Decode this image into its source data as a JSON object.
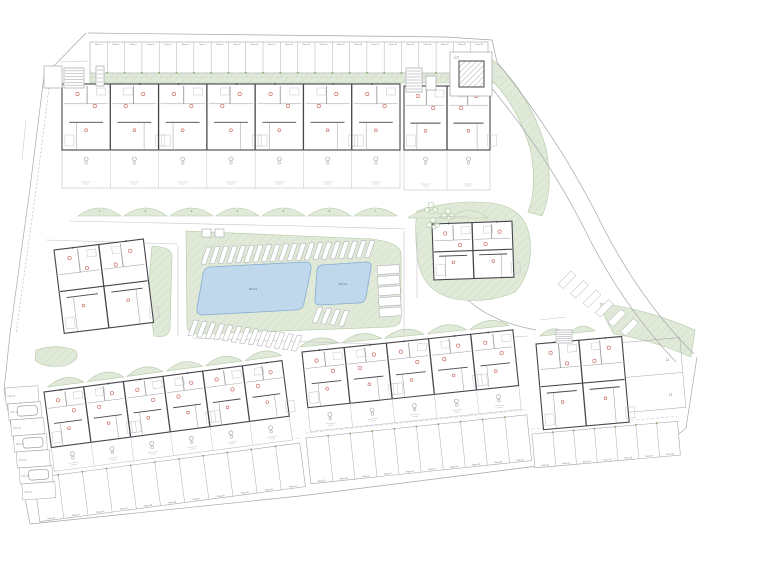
{
  "palette": {
    "green": "#e1ead9",
    "green_line": "#b3c8a6",
    "pool": "#bfd8ec",
    "pool_line": "#85aed2",
    "pool_text": "#55718f",
    "wall": "#45454c",
    "wall_light": "#9b9ba3",
    "faint": "#c3c3ca",
    "line": "#a6a6ae",
    "red": "#c65f57",
    "text": "#70707a",
    "tick_green": "#7fae6f"
  },
  "labels": {
    "ct": "CT",
    "pool_large": "Piscina",
    "pool_small": "Piscina",
    "stall_prefix": "Plaza",
    "unit_numbers_top": [
      "1",
      "2",
      "3",
      "4",
      "5",
      "6",
      "7"
    ],
    "plot_numbers": [
      "11",
      "12"
    ]
  },
  "site": {
    "boundary": [
      {
        "pts": "86,33 44,76 30,188 10,334 4,390 30,524"
      },
      {
        "pts": "88,33 446,37"
      },
      {
        "pts": "446,37 492,40 497,62"
      },
      {
        "pts": "30,524 300,496 522,468 660,450 686,428 697,357"
      },
      {
        "pts": "50,80 36,190 16,334",
        "dash": "2,2",
        "w": 0.5
      }
    ],
    "roads": [
      {
        "pts": "70,221 300,226 405,229"
      },
      {
        "pts": "46,240 178,244"
      },
      {
        "pts": "404,231 404,333"
      },
      {
        "pts": "417,232 417,298"
      },
      {
        "pts": "192,338 405,345"
      },
      {
        "pts": "405,345 528,336"
      },
      {
        "pts": "178,246 178,336"
      }
    ],
    "road_curves": [
      "M497,62 Q560,140 602,225 Q640,300 694,354",
      "M480,74 Q545,150 586,232 Q622,305 676,362",
      "M468,300 Q492,322 536,330"
    ],
    "greens": [
      {
        "name": "green-top-strip",
        "d": "M90,71 L505,71 L505,83 L90,83 Z"
      },
      {
        "name": "green-right-band",
        "d": "M489,57 Q528,88 546,148 Q554,190 542,216 L528,212 Q538,186 530,148 Q514,96 480,70 Z"
      },
      {
        "name": "green-central-island",
        "d": "M186,231 L372,239 Q400,243 401,253 L401,318 Q401,326 390,327 L198,334 Q187,334 187,325 Z"
      },
      {
        "name": "green-community",
        "d": "M417,211 Q452,199 492,203 Q527,208 530,240 Q533,272 515,292 Q488,304 455,299 Q423,292 418,261 Q414,232 417,211 Z"
      },
      {
        "name": "green-band-left",
        "d": "M152,246 Q173,247 172,257 L170,328 Q169,339 154,336 Q148,295 150,268 Z"
      },
      {
        "name": "green-blob-left",
        "d": "M36,350 Q58,343 76,351 Q81,361 64,366 Q43,368 35,360 Z"
      },
      {
        "name": "green-right-wedge",
        "d": "M600,303 Q650,310 695,330 L691,357 Q655,341 614,334 Q604,318 600,303 Z"
      }
    ],
    "mound_rows": [
      {
        "name": "gardens-top",
        "x": 78,
        "y": 216,
        "n": 7,
        "w": 43,
        "gap": 3,
        "rise": 16,
        "dy": 0
      },
      {
        "name": "gardens-top-b",
        "x": 408,
        "y": 218,
        "n": 2,
        "w": 38,
        "gap": 4,
        "rise": 15,
        "dy": 0
      },
      {
        "name": "gardens-bottom-left",
        "x": 48,
        "y": 387,
        "n": 6,
        "w": 36,
        "gap": 3.5,
        "rise": 14,
        "dy": -0.134
      },
      {
        "name": "gardens-bottom-mid",
        "x": 300,
        "y": 347,
        "n": 5,
        "w": 39,
        "gap": 3.5,
        "rise": 14,
        "dy": -0.103
      },
      {
        "name": "gardens-bottom-right",
        "x": 540,
        "y": 336,
        "n": 2,
        "w": 26,
        "gap": 3,
        "rise": 12,
        "dy": -0.09
      }
    ],
    "pools": [
      {
        "name": "pool-large",
        "label": "pool_large",
        "lx": 253,
        "ly": 290,
        "d": "M210,267 L305,262 Q312,262 311,269 L304,303 Q303,310 295,310 L203,315 Q196,315 197,308 L203,274 Q204,268 210,267 Z"
      },
      {
        "name": "pool-small",
        "label": "pool_small",
        "lx": 343,
        "ly": 285,
        "d": "M322,265 L366,262 Q372,262 371,268 L366,297 Q365,303 358,303 L320,305 Q314,305 315,299 L317,271 Q317,266 322,265 Z"
      }
    ],
    "parking_rows": [
      {
        "name": "parking-row-top",
        "x": 90,
        "y": 42,
        "w": 398,
        "h": 31,
        "n": 23,
        "rot": 0,
        "start": 1,
        "labelPos": "top",
        "ticks": true,
        "tickPos": "bottom",
        "dashDy": 35,
        "dashExt": 17
      },
      {
        "name": "parking-band-bottom-left",
        "x": 34,
        "y": 478,
        "w": 268,
        "h": 44,
        "n": 11,
        "rot": -7.5,
        "start": 31,
        "labelPos": "bottom",
        "ticks": true,
        "tickPos": "top",
        "dashDy": -5
      },
      {
        "name": "parking-band-bottom-mid",
        "x": 306,
        "y": 438,
        "w": 222,
        "h": 46,
        "n": 10,
        "rot": -6,
        "start": 42,
        "labelPos": "bottom",
        "ticks": true,
        "tickPos": "top",
        "dashDy": -5
      },
      {
        "name": "parking-band-bottom-right",
        "x": 532,
        "y": 434,
        "w": 146,
        "h": 34,
        "n": 7,
        "rot": -5,
        "start": 52,
        "labelPos": "bottom",
        "ticks": true,
        "tickPos": "top",
        "dashDy": -5
      }
    ],
    "stall_column": {
      "name": "parking-column-left",
      "x": 5,
      "y": 388,
      "w": 33,
      "h": 16,
      "n": 7,
      "shift": 2.8,
      "rot": -4,
      "start": 24,
      "cars": [
        1,
        3,
        5
      ]
    },
    "angled_rows": [
      {
        "name": "stalls-island-top",
        "x": 201,
        "y": 264,
        "n": 20,
        "dx": 8.6,
        "dy": -0.35,
        "a": [
          4.8,
          0.2
        ],
        "b": [
          5.7,
          -17
        ]
      },
      {
        "name": "stalls-island-bottom",
        "x": 194,
        "y": 320,
        "n": 13,
        "dx": 8.6,
        "dy": 1.25,
        "a": [
          4.8,
          0.6
        ],
        "b": [
          -6,
          15.5
        ]
      },
      {
        "name": "stalls-island-right",
        "x": 377,
        "y": 266,
        "n": 5,
        "dx": 0.5,
        "dy": 10.6,
        "a": [
          0.5,
          8.6
        ],
        "b": [
          22,
          -1.5
        ]
      },
      {
        "name": "stalls-pool2-south",
        "x": 318,
        "y": 307,
        "n": 4,
        "dx": 8.8,
        "dy": 1.1,
        "a": [
          4.8,
          0.6
        ],
        "b": [
          -6,
          15.5
        ]
      },
      {
        "name": "stalls-road-curve",
        "x": 558,
        "y": 284,
        "n": 6,
        "dx": 12.5,
        "dy": 9.5,
        "a": [
          5,
          4.5
        ],
        "b": [
          13,
          -13
        ]
      }
    ],
    "buildings": [
      {
        "name": "building-row-top-a",
        "x": 62,
        "y": 84,
        "w": 338,
        "h": 66,
        "terr": 38,
        "units": 7,
        "rot": 0
      },
      {
        "name": "building-row-top-b",
        "x": 404,
        "y": 86,
        "w": 86,
        "h": 64,
        "terr": 40,
        "units": 2,
        "rot": 0
      },
      {
        "name": "building-left-block",
        "x": 54,
        "y": 250,
        "w": 90,
        "h": 84,
        "terr": 0,
        "units": 2,
        "rot": -7,
        "mid": true
      },
      {
        "name": "building-community",
        "x": 432,
        "y": 224,
        "w": 80,
        "h": 56,
        "terr": 0,
        "units": 2,
        "rot": -2,
        "mid": true
      },
      {
        "name": "building-row-bottom-left",
        "x": 44,
        "y": 392,
        "w": 240,
        "h": 56,
        "terr": 24,
        "units": 6,
        "rot": -7.5
      },
      {
        "name": "building-row-bottom-mid",
        "x": 302,
        "y": 352,
        "w": 212,
        "h": 56,
        "terr": 24,
        "units": 5,
        "rot": -6
      },
      {
        "name": "building-bottom-right-block",
        "x": 536,
        "y": 344,
        "w": 86,
        "h": 86,
        "terr": 0,
        "units": 2,
        "rot": -5,
        "mid": true
      }
    ],
    "ct": {
      "x": 450,
      "y": 52,
      "w": 42,
      "h": 44,
      "inner": {
        "x": 459,
        "y": 61,
        "w": 25,
        "h": 26
      }
    },
    "ancillary": [
      {
        "x": 44,
        "y": 66,
        "w": 18,
        "h": 22,
        "stripes": 0
      },
      {
        "x": 64,
        "y": 68,
        "w": 20,
        "h": 20,
        "stripes": 6
      },
      {
        "x": 96,
        "y": 66,
        "w": 8,
        "h": 20,
        "stripes": 4
      },
      {
        "x": 406,
        "y": 68,
        "w": 16,
        "h": 24,
        "stripes": 7
      },
      {
        "x": 426,
        "y": 76,
        "w": 10,
        "h": 14,
        "stripes": 0
      },
      {
        "x": 556,
        "y": 330,
        "w": 16,
        "h": 13,
        "stripes": 5
      }
    ],
    "plots": {
      "x": 606,
      "y": 344,
      "w": 74,
      "h": 70,
      "rot": -5
    },
    "trees": [
      {
        "cx": 431,
        "cy": 208
      },
      {
        "cx": 448,
        "cy": 214
      },
      {
        "cx": 433,
        "cy": 223
      }
    ],
    "signs": [
      {
        "x": 202,
        "y": 229,
        "w": 9,
        "h": 8
      },
      {
        "x": 215,
        "y": 229,
        "w": 9,
        "h": 8
      }
    ]
  }
}
